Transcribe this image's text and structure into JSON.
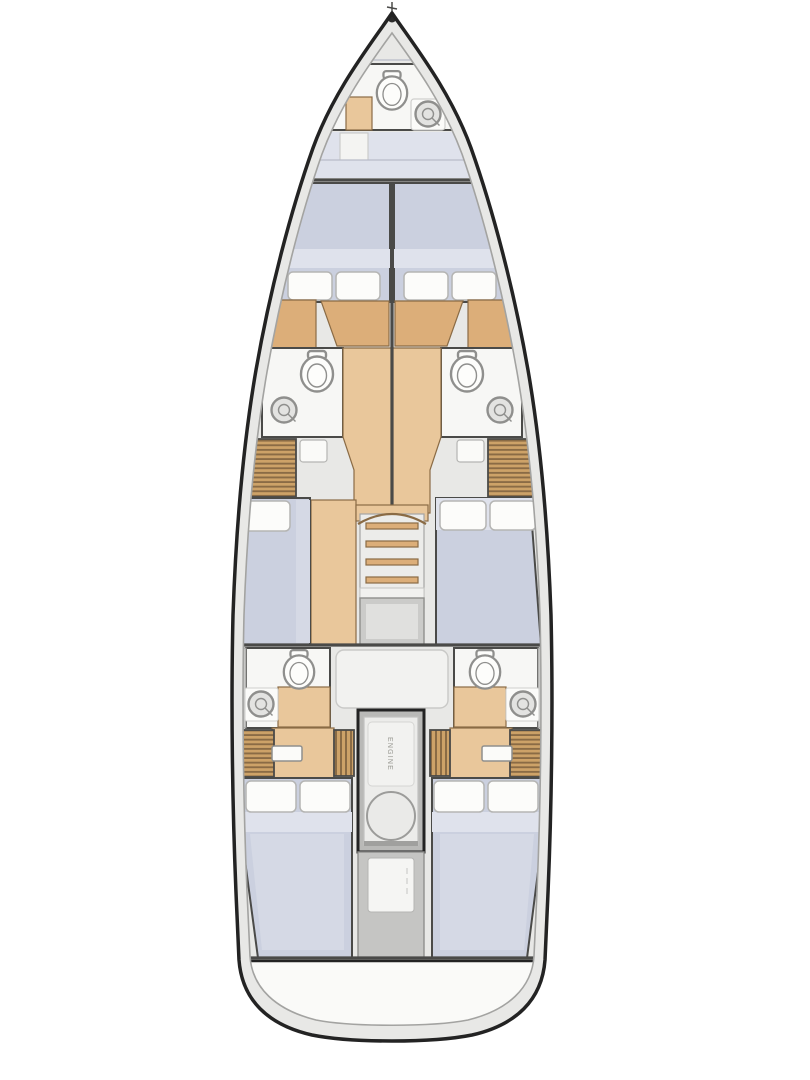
{
  "diagram": {
    "kind": "yacht-interior-floorplan"
  },
  "labels": {
    "engine": "ENGINE"
  },
  "colors": {
    "deck": "#e8e8e6",
    "hull_line": "#232323",
    "inner_line": "#a3a3a1",
    "room": "#f7f7f5",
    "room_soft": "#f2f2f0",
    "berth": "#cbd0df",
    "berth_light": "#dfe2ec",
    "berth_sheet": "#d5d9e5",
    "pillow": "#fcfcfa",
    "pillow_line": "#b5b5b3",
    "wood": "#e9c79b",
    "wood_mid": "#dcae79",
    "wood_line": "#8a6b45",
    "stripe_base": "#cda268",
    "stripe_dark": "#8a6b45",
    "gray_panel": "#c9c9c7",
    "fixture_fill": "#fdfdfb",
    "fixture_line": "#8f8f8d",
    "sink_fill": "#e3e3e1",
    "wall": "#4a4a48",
    "engine_outer": "#b9b9b7",
    "engine_inner": "#ececea",
    "transom": "#fafaf8"
  }
}
